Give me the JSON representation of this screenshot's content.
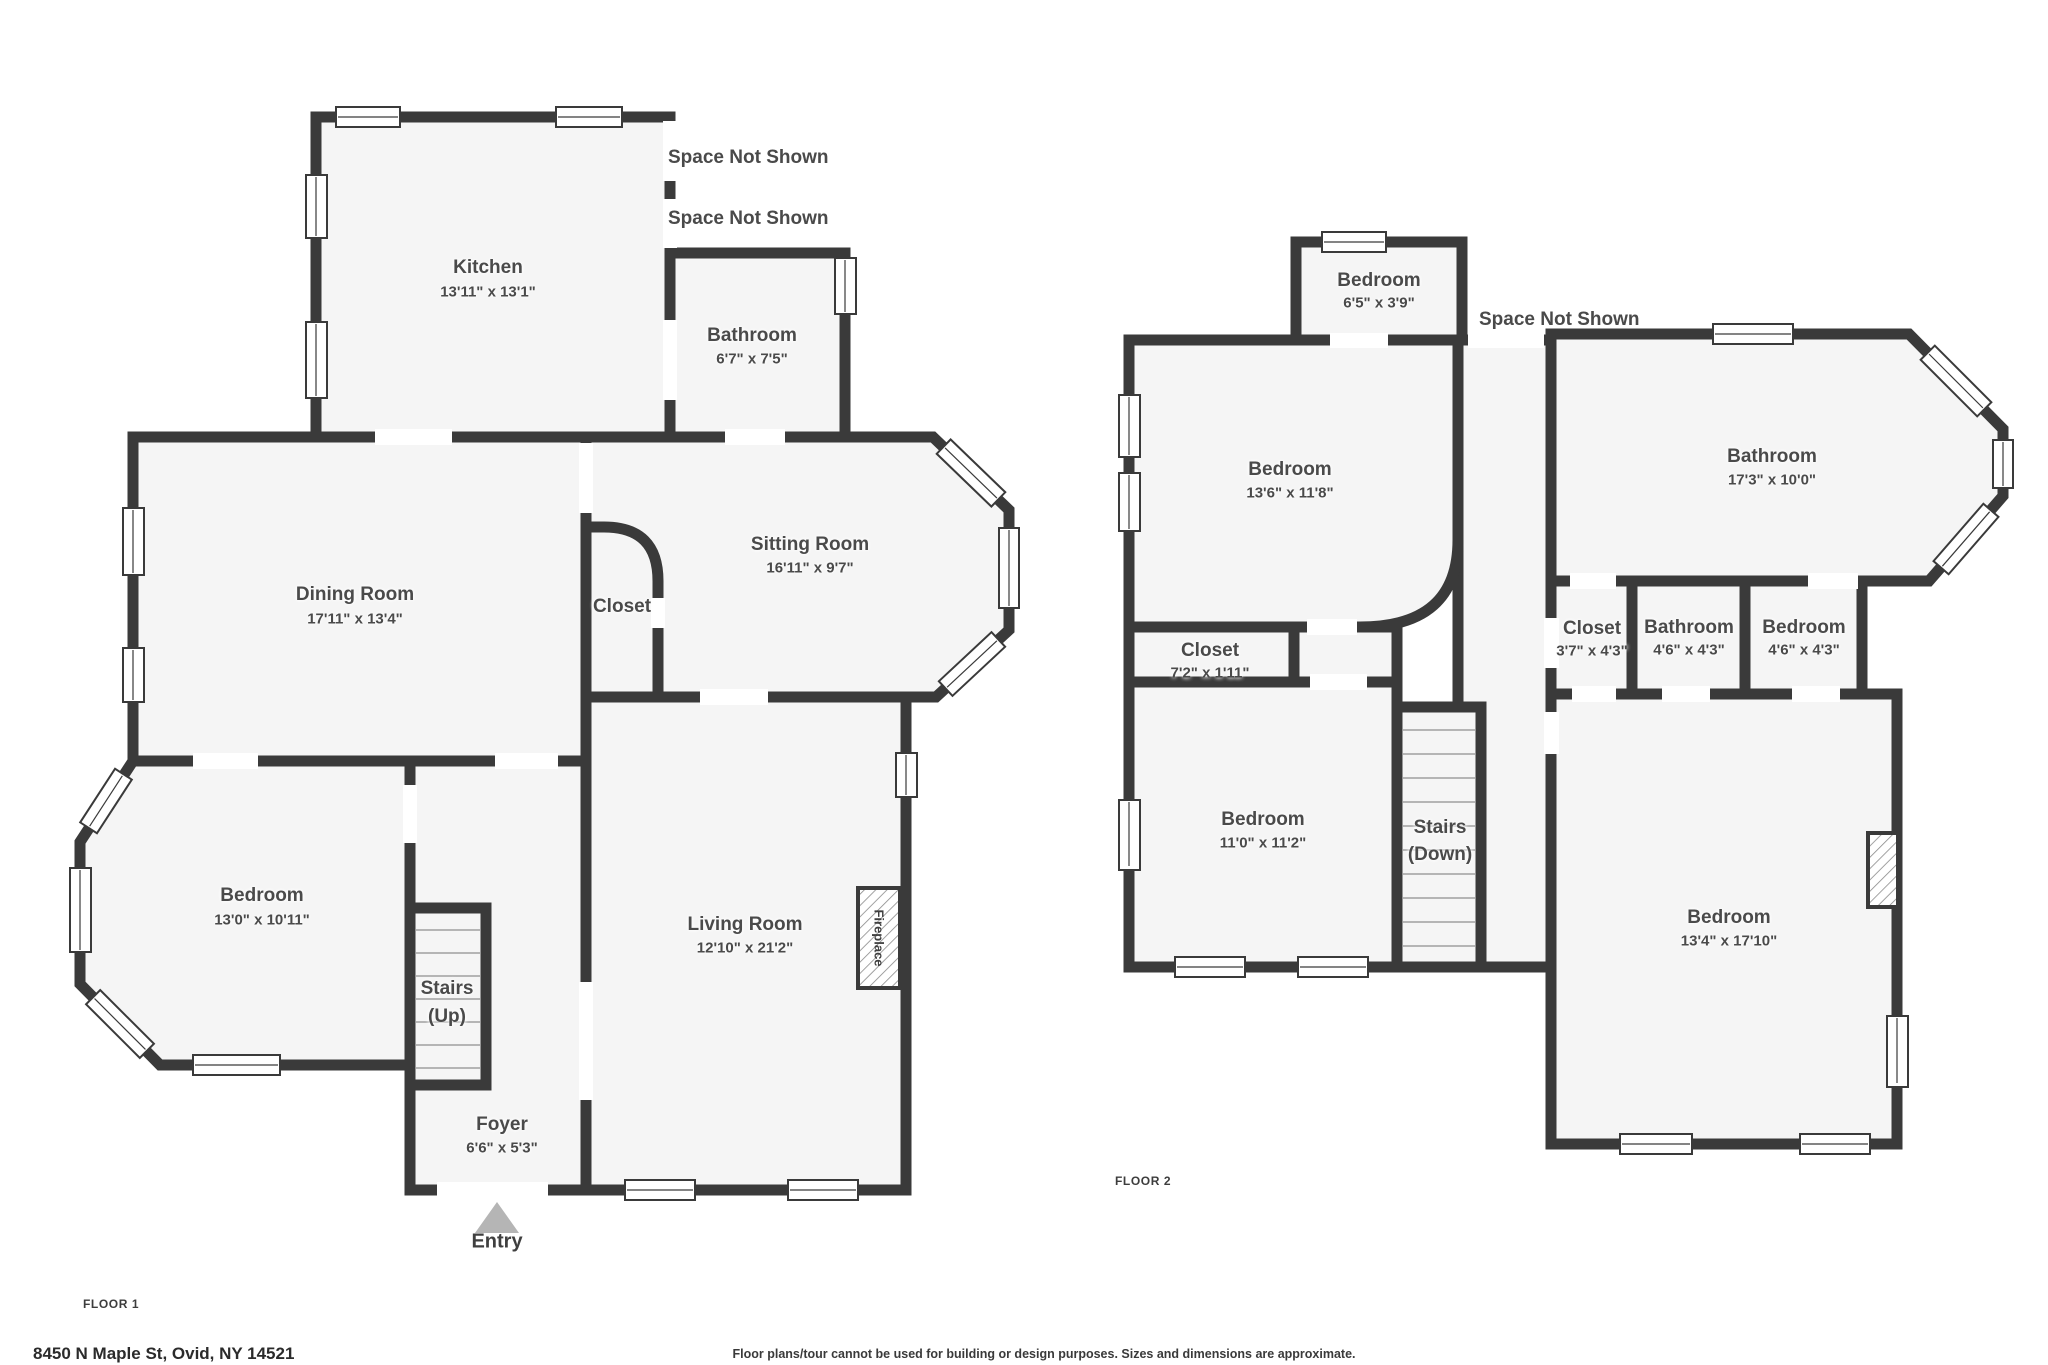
{
  "colors": {
    "wall": "#3a3a3a",
    "floor": "#f5f5f5",
    "background": "#ffffff",
    "label": "#4a4a4a",
    "entry_arrow": "#b5b5b5"
  },
  "floor1": {
    "tag": "FLOOR 1",
    "rooms": {
      "kitchen": {
        "name": "Kitchen",
        "dims": "13'11\" x 13'1\""
      },
      "bathroom": {
        "name": "Bathroom",
        "dims": "6'7\" x 7'5\""
      },
      "dining": {
        "name": "Dining Room",
        "dims": "17'11\" x 13'4\""
      },
      "closet": {
        "name": "Closet"
      },
      "sitting": {
        "name": "Sitting Room",
        "dims": "16'11\" x 9'7\""
      },
      "bedroom": {
        "name": "Bedroom",
        "dims": "13'0\" x 10'11\""
      },
      "living": {
        "name": "Living Room",
        "dims": "12'10\" x 21'2\""
      },
      "foyer": {
        "name": "Foyer",
        "dims": "6'6\" x 5'3\""
      }
    },
    "stairs": {
      "line1": "Stairs",
      "line2": "(Up)"
    },
    "fireplace": "Fireplace",
    "entry": "Entry",
    "space_not_shown_1": "Space Not Shown",
    "space_not_shown_2": "Space Not Shown"
  },
  "floor2": {
    "tag": "FLOOR 2",
    "rooms": {
      "bedroom_top": {
        "name": "Bedroom",
        "dims": "6'5\" x 3'9\""
      },
      "bedroom_left": {
        "name": "Bedroom",
        "dims": "13'6\" x 11'8\""
      },
      "bathroom_main": {
        "name": "Bathroom",
        "dims": "17'3\" x 10'0\""
      },
      "closet_wide": {
        "name": "Closet",
        "dims": "7'2\" x 1'11\""
      },
      "closet_small": {
        "name": "Closet",
        "dims": "3'7\" x 4'3\""
      },
      "bathroom_small": {
        "name": "Bathroom",
        "dims": "4'6\" x 4'3\""
      },
      "bedroom_small": {
        "name": "Bedroom",
        "dims": "4'6\" x 4'3\""
      },
      "bedroom_mid": {
        "name": "Bedroom",
        "dims": "11'0\" x 11'2\""
      },
      "bedroom_big": {
        "name": "Bedroom",
        "dims": "13'4\" x 17'10\""
      }
    },
    "stairs": {
      "line1": "Stairs",
      "line2": "(Down)"
    },
    "space_not_shown": "Space Not Shown"
  },
  "footer": {
    "address": "8450 N Maple St, Ovid, NY 14521",
    "disclaimer": "Floor plans/tour cannot be used for building or design purposes. Sizes and dimensions are approximate."
  }
}
